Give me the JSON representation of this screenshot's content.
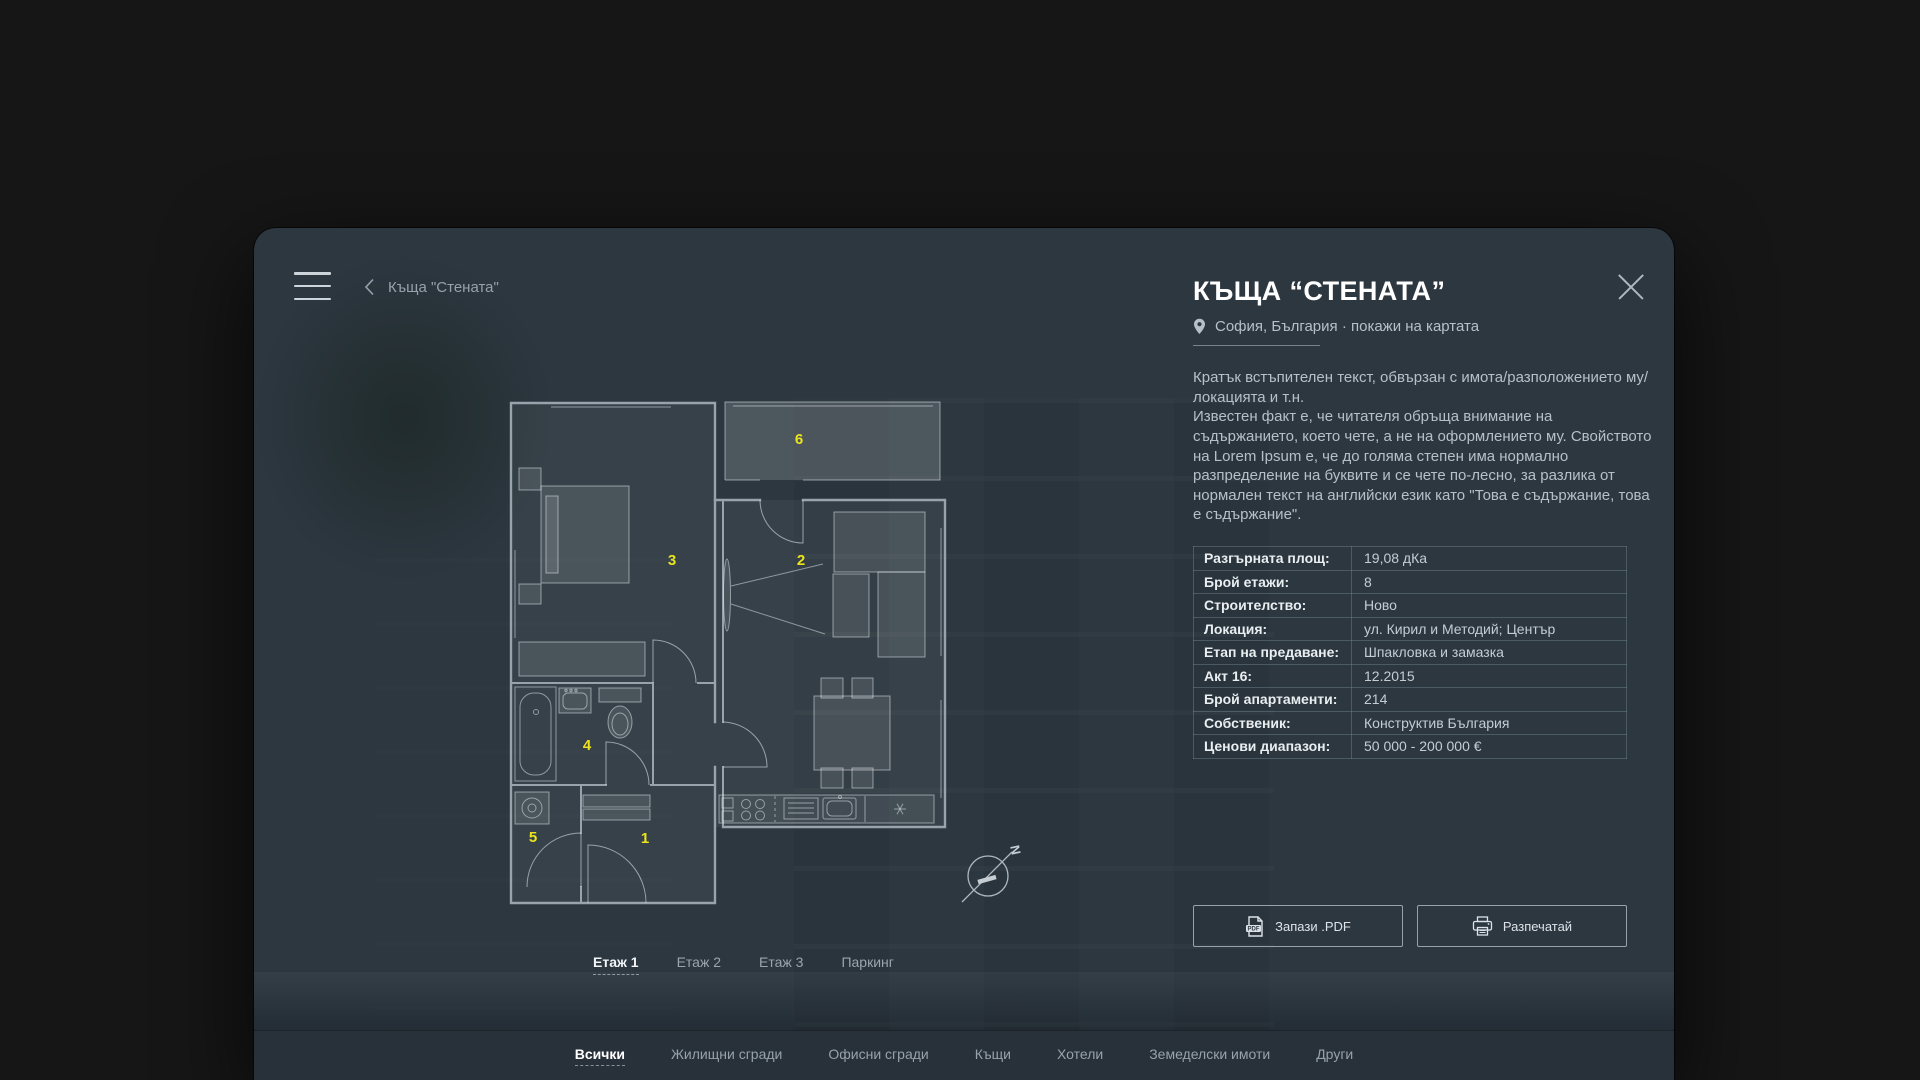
{
  "colors": {
    "window_bg": "#2c3740",
    "outside_bg": "#161616",
    "accent_yellow": "#ebe41c",
    "text_primary": "#ffffff",
    "text_secondary": "#9aa5ad",
    "table_border": "#5c7283"
  },
  "topbar": {
    "breadcrumb_title": "Къща \"Стената\""
  },
  "header": {
    "title": "КЪЩА “СТЕНАТА”",
    "location": "София, България · покажи на картата"
  },
  "intro": {
    "p1": "Кратък встъпителен текст, обвързан с имота/разположението му/локацията и т.н.",
    "p2": "Известен факт е, че читателя обръща внимание на съдържанието, което чете, а не на оформлението му. Свойството на Lorem Ipsum е, че до голяма степен има нормално разпределение на буквите и се чете по-лесно, за разлика от нормален текст на английски език като \"Това е съдържание, това е съдържание\"."
  },
  "details": {
    "rows": [
      {
        "label": "Разгърната площ:",
        "value": "19,08 дКа"
      },
      {
        "label": "Брой етажи:",
        "value": "8"
      },
      {
        "label": "Строителство:",
        "value": "Ново"
      },
      {
        "label": "Локация:",
        "value": "ул. Кирил и Методий; Център"
      },
      {
        "label": "Етап на предаване:",
        "value": "Шпакловка и замазка"
      },
      {
        "label": "Акт 16:",
        "value": "12.2015"
      },
      {
        "label": "Брой апартаменти:",
        "value": "214"
      },
      {
        "label": "Собственик:",
        "value": "Конструктив България"
      },
      {
        "label": "Ценови диапазон:",
        "value": "50 000 - 200 000 €"
      }
    ]
  },
  "actions": {
    "save_pdf": "Запази .PDF",
    "print": "Разпечатай"
  },
  "floor_tabs": [
    {
      "label": "Етаж 1",
      "active": true
    },
    {
      "label": "Етаж 2",
      "active": false
    },
    {
      "label": "Етаж 3",
      "active": false
    },
    {
      "label": "Паркинг",
      "active": false
    }
  ],
  "bottom_nav": [
    {
      "label": "Всички",
      "active": true
    },
    {
      "label": "Жилищни сгради",
      "active": false
    },
    {
      "label": "Офисни сгради",
      "active": false
    },
    {
      "label": "Къщи",
      "active": false
    },
    {
      "label": "Хотели",
      "active": false
    },
    {
      "label": "Земеделски имоти",
      "active": false
    },
    {
      "label": "Други",
      "active": false
    }
  ],
  "floorplan": {
    "room_labels": {
      "hallway": "1",
      "living": "2",
      "bedroom": "3",
      "bathroom": "4",
      "storage": "5",
      "balcony": "6"
    },
    "compass_letter": "N"
  }
}
